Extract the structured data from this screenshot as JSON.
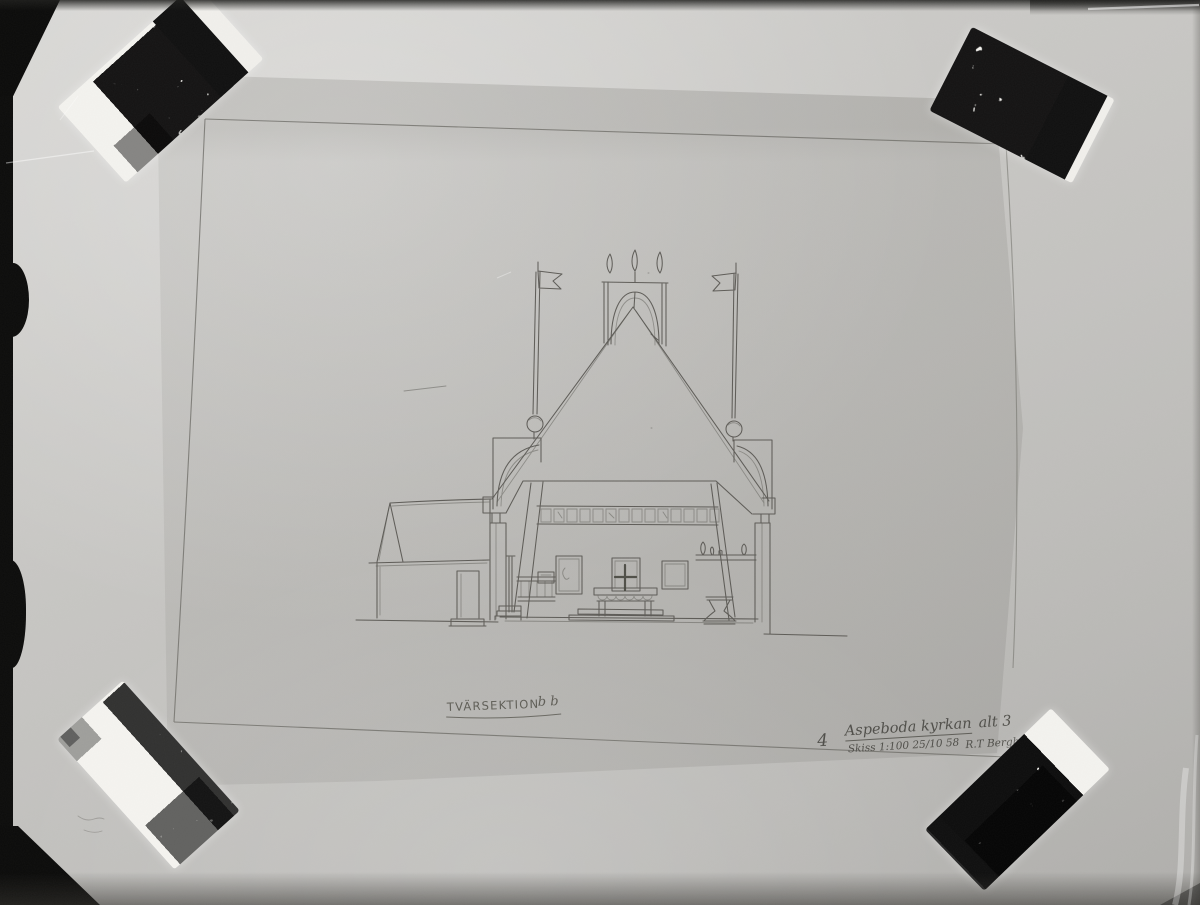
{
  "caption": {
    "label": "TVÄRSEKTION",
    "marks": "b b"
  },
  "annotation": {
    "number": "4",
    "title_main": "Aspeboda kyrkan",
    "title_suffix": "alt 3",
    "scale_date": "Skiss 1:100 25/10 58",
    "signature": "R.T Bergh"
  },
  "colors": {
    "photo_background": "#c7c6c3",
    "sheet_tint": "#b4b2ae",
    "pencil": "#54534e",
    "film_edge": "#0c0c0b",
    "tape_base": "#f4f3ef",
    "tape_marble": "#101010"
  }
}
